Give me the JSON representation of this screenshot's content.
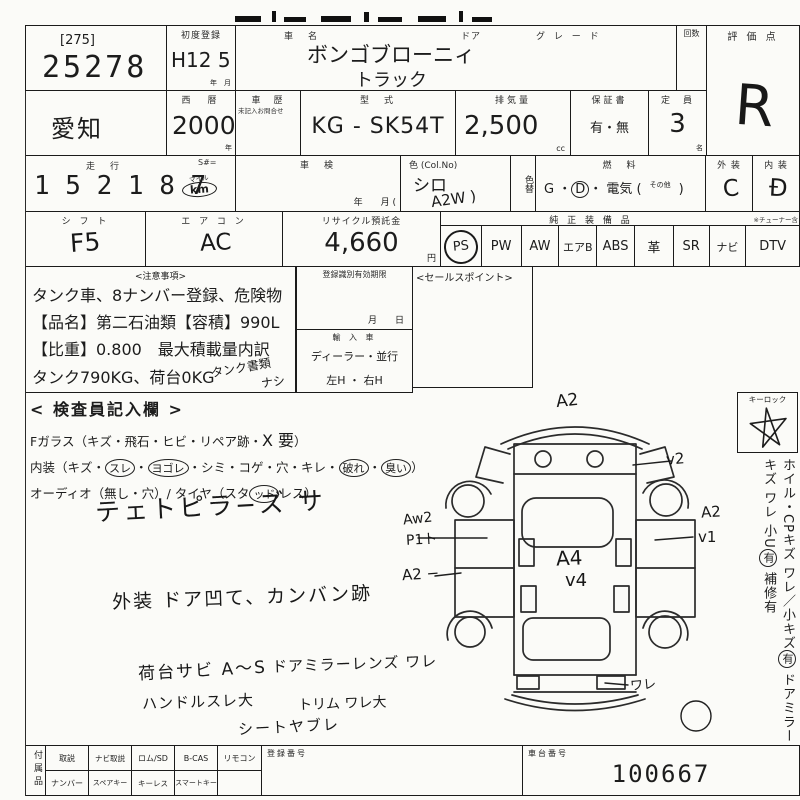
{
  "row1": {
    "lot_tag": "[275]",
    "lot_no": "25278",
    "first_reg_label": "初度登録",
    "first_reg_value": "H12 5",
    "first_reg_unit": "年　月",
    "name_label": "車　名",
    "door_label": "ドア",
    "grade_label": "グ レ ー ド",
    "count_label": "回数",
    "score_label": "評 価 点",
    "score_value": "R",
    "name_value1": "ボンゴブローニィ",
    "name_value2": "トラック"
  },
  "row2": {
    "pref": "愛知",
    "year_label": "西　暦",
    "year": "2000",
    "year_unit": "年",
    "hist_label": "車　歴",
    "hist_note": "未記入お問合せ",
    "model_label": "型　式",
    "model": "KG - SK54T",
    "disp_label": "排気量",
    "disp": "2,500",
    "disp_unit": "cc",
    "warr_label": "保証書",
    "warr": "有・無",
    "cap_label": "定　員",
    "cap": "3",
    "cap_unit": "名"
  },
  "row3": {
    "run_label": "走　行",
    "run_sub": "S#=",
    "odo": "1 5 2  1 8 7",
    "mile": "マイル",
    "km": "km",
    "shaken_label": "車　検",
    "shaken_unit": "年　　月 (",
    "color_label": "色 (Col.No)",
    "color": "シロ",
    "color_hand": "A2W )",
    "colorchg": "色替",
    "fuel_label": "燃　料",
    "fuel_pre": "G ・",
    "fuel_d": "D",
    "fuel_mid": "・ 電気 (",
    "fuel_other": "その他",
    "fuel_post": ")",
    "ext_label": "外 装",
    "ext": "C",
    "int_label": "内 装",
    "int": "Đ"
  },
  "row4": {
    "shift_label": "シ フ ト",
    "shift": "F5",
    "ac_label": "エ ア コ ン",
    "ac": "AC",
    "rec_label": "リサイクル預託金",
    "rec": "4,660",
    "rec_unit": "円",
    "equip_label": "純 正 装 備 品",
    "equip": [
      "PS",
      "PW",
      "AW",
      "エアB",
      "ABS",
      "革",
      "SR",
      "ナビ"
    ],
    "dtv_note": "※チューナー含",
    "dtv": "DTV"
  },
  "notice": {
    "title": "<注意事項>",
    "l1": "タンク車、8ナンバー登録、危険物",
    "l2": "【品名】第二石油類【容積】990L",
    "l3": "【比重】0.800　最大積載量内訳",
    "l4": "タンク790KG、荷台0KG",
    "hand1": "タンク書類",
    "hand2": "ナシ"
  },
  "mid": {
    "expiry_label": "登録識別有効期限",
    "expiry_unit": "月　　日",
    "import_label": "輸 入 車",
    "import_opts": "ディーラー・並行",
    "handle_opts": "左H ・ 右H",
    "sales": "<セールスポイント>"
  },
  "inspect": {
    "title": "< 検査員記入欄 >",
    "g_pre": "Fガラス（キズ・飛石・ヒビ・リペア跡・",
    "g_hand": "X 要",
    "g_post": "）",
    "i_pre": "内装（キズ・",
    "i_c1": "スレ",
    "i_s1": "・",
    "i_c2": "ヨゴレ",
    "i_s2": "・シミ・コゲ・穴・キレ・",
    "i_c3": "破れ",
    "i_s3": "・",
    "i_c4": "臭い",
    "i_post": "）",
    "a_pre": "オーディオ（無し・穴）/ タイヤ（スタ",
    "a_c": "ッド",
    "a_post": "レス）",
    "hand": "テェトピラ−ズ サ"
  },
  "hand_notes": {
    "ext": "外装 ドア凹て、カンバン跡",
    "bed": "荷台サビ A〜S",
    "mirror": "ドアミラーレンズ ワレ",
    "handle": "ハンドルスレ大",
    "trim": "トリム ワレ大",
    "seat": "シートヤブレ"
  },
  "diagram": {
    "top": "A2",
    "vr": "v2",
    "r1": "A2",
    "r2": "v1",
    "c1": "A4",
    "c2": "v4",
    "l1": "Aw2",
    "l2": "P1ト",
    "l3": "A2 −",
    "crack": "ワレ",
    "keylock": "キーロック"
  },
  "side": {
    "s1": "ホイル・CPキズ ワレ／小キズ",
    "c1": "有",
    "s2": " ドアミラーキズ ワレ 小U",
    "c2": "有",
    "s3": " 補修有"
  },
  "bottom": {
    "acc_label": "付属品",
    "r1": [
      "取説",
      "ナビ取説",
      "ロム/SD",
      "B-CAS",
      "リモコン"
    ],
    "r2": [
      "ナンバー",
      "スペアキー",
      "キーレス",
      "スマートキー",
      ""
    ],
    "reg_label": "登録番号",
    "chassis_label": "車台番号",
    "chassis": "100667"
  }
}
